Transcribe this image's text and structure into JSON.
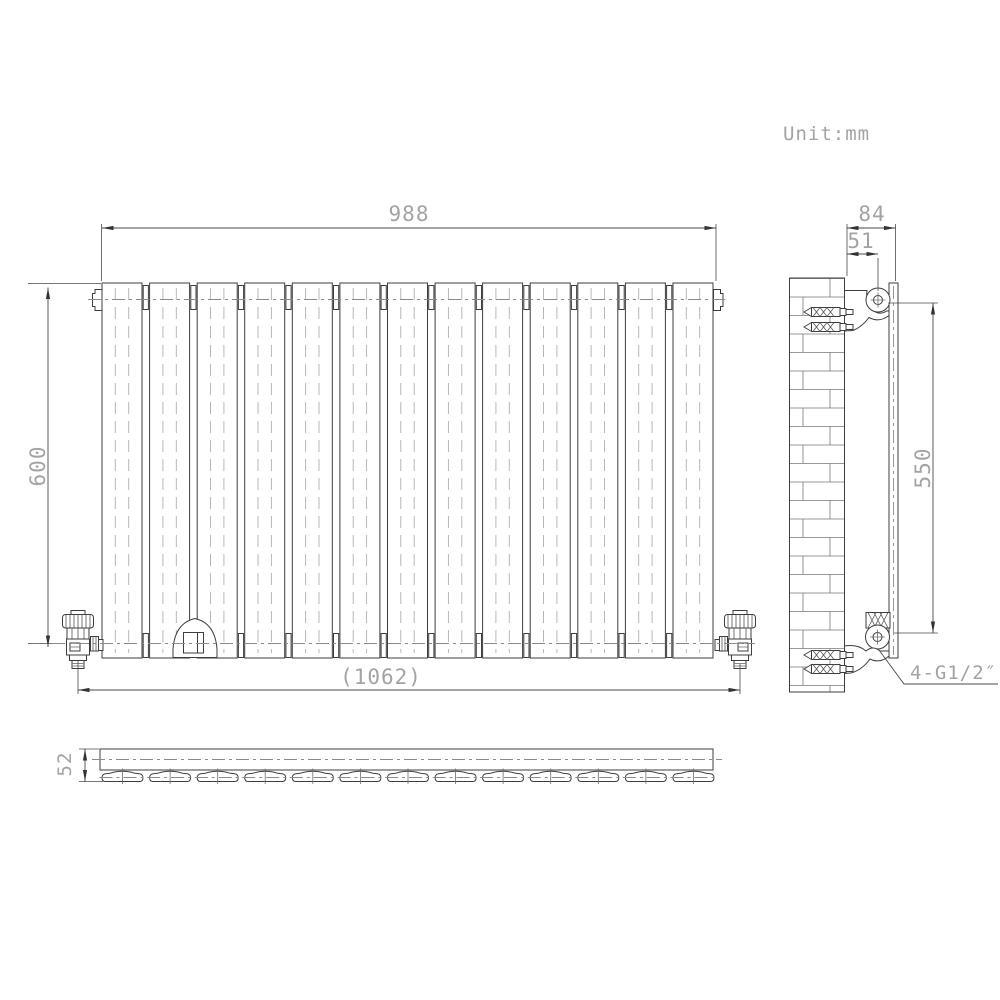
{
  "meta": {
    "unit_label": "Unit:mm"
  },
  "front_view": {
    "panel_count": 13,
    "dim_width": "988",
    "dim_height": "600",
    "dim_overall_width": "(1062)"
  },
  "side_view": {
    "dim_bracket_depth": "84",
    "dim_wall_to_hook": "51",
    "dim_connection_span": "550",
    "connection_thread_label": "4-G1/2″"
  },
  "plan_view": {
    "dim_depth": "52"
  },
  "style": {
    "outline_color": "#3d3d3d",
    "dimension_text_color": "#a3a3a3",
    "centerline_color": "#8a8a8a",
    "background_color": "#ffffff"
  }
}
